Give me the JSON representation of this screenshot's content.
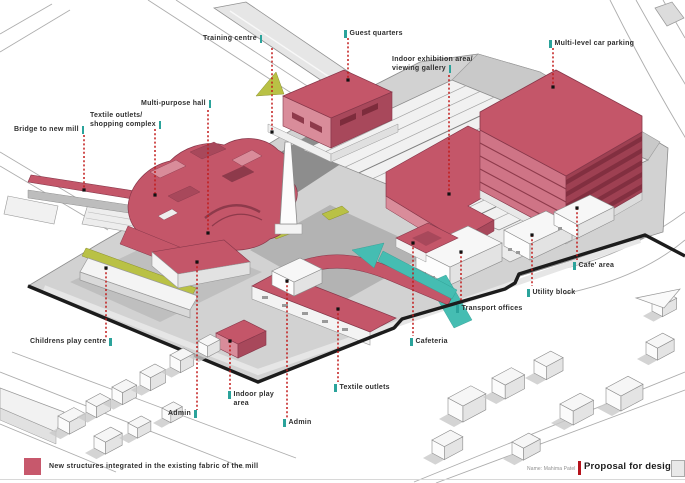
{
  "footer": {
    "credit": "Name: Mahima Patel",
    "title": "Proposal for design"
  },
  "legend": {
    "text": "New structures integrated in the existing fabric of the mill",
    "swatch_color": "#c7586c"
  },
  "colors": {
    "new_structure_pink": "#c45669",
    "new_structure_pink_light": "#d98c9a",
    "new_structure_pink_dark": "#a8485b",
    "circulation_teal": "#45bdb2",
    "leader_red": "#c21a1a",
    "tick_teal": "#2ba39b",
    "landscape_olive": "#b9c145",
    "boundary_black": "#1c1c1c"
  },
  "labels": [
    {
      "id": "training-centre",
      "text": "Training centre"
    },
    {
      "id": "guest-quarters",
      "text": "Guest quarters"
    },
    {
      "id": "multi-level-car-parking",
      "text": "Multi-level car parking"
    },
    {
      "id": "indoor-exhibition",
      "line1": "Indoor exhibition area/",
      "line2": "viewing gallery"
    },
    {
      "id": "multi-purpose-hall",
      "text": "Multi-purpose hall"
    },
    {
      "id": "textile-outlets-complex",
      "line1": "Textile outlets/",
      "line2": "shopping complex"
    },
    {
      "id": "bridge-to-new-mill",
      "text": "Bridge to new mill"
    },
    {
      "id": "childrens-play-centre",
      "text": "Childrens play centre"
    },
    {
      "id": "indoor-play-area",
      "line1": "Indoor play",
      "line2": "area"
    },
    {
      "id": "admin-west",
      "text": "Admin"
    },
    {
      "id": "admin-south",
      "text": "Admin"
    },
    {
      "id": "textile-outlets",
      "text": "Textile outlets"
    },
    {
      "id": "cafeteria",
      "text": "Cafeteria"
    },
    {
      "id": "transport-offices",
      "text": "Transport offices"
    },
    {
      "id": "utility-block",
      "text": "Utility block"
    },
    {
      "id": "cafe-area",
      "text": "Cafe' area"
    }
  ]
}
